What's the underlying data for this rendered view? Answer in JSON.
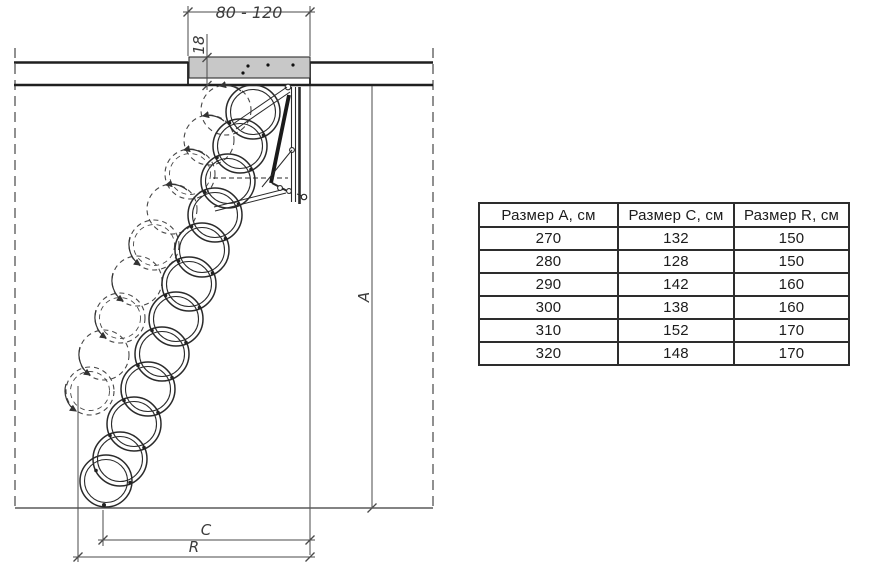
{
  "drawing": {
    "labels": {
      "opening_width": "80 - 120",
      "hatch_thickness": "18",
      "height": "A",
      "projection": "C",
      "clearance": "R"
    }
  },
  "table": {
    "headers": [
      "Размер А, см",
      "Размер С, см",
      "Размер R, см"
    ],
    "rows": [
      [
        "270",
        "132",
        "150"
      ],
      [
        "280",
        "128",
        "150"
      ],
      [
        "290",
        "142",
        "160"
      ],
      [
        "300",
        "138",
        "160"
      ],
      [
        "310",
        "152",
        "170"
      ],
      [
        "320",
        "148",
        "170"
      ]
    ]
  },
  "colors": {
    "line": "#2a2a2a",
    "dim_line": "#4a4a4a",
    "hatch_fill": "#c8c8c8",
    "background": "#ffffff"
  }
}
